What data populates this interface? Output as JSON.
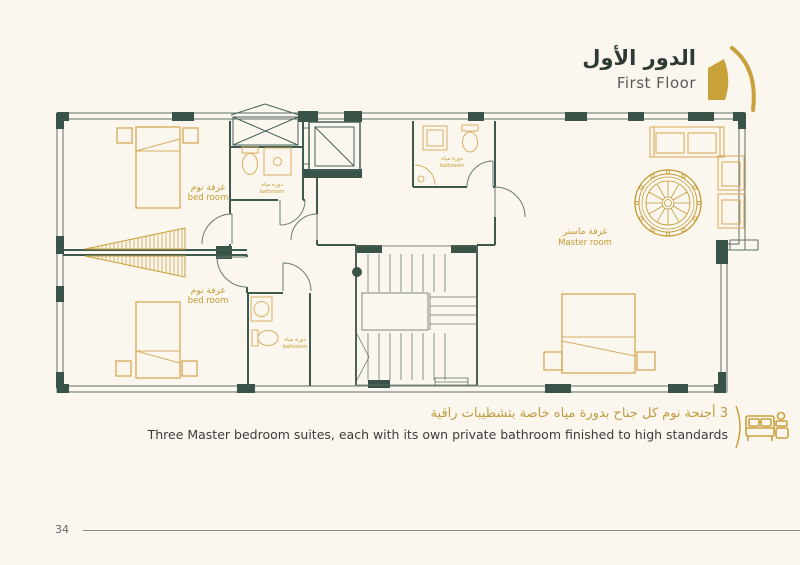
{
  "page": {
    "number": "34"
  },
  "header": {
    "title_ar": "الدور الأول",
    "title_en": "First Floor"
  },
  "plan": {
    "bedroom1": {
      "ar": "غرفة نوم",
      "en": "bed room"
    },
    "bedroom2": {
      "ar": "غرفة نوم",
      "en": "bed room"
    },
    "master": {
      "ar": "غرفة ماستر",
      "en": "Master room"
    },
    "bathroom1": {
      "ar": "دورة مياه",
      "en": "bathroom"
    },
    "bathroom2": {
      "ar": "دورة مياه",
      "en": "bathroom"
    },
    "bathroom3": {
      "ar": "دورة مياه",
      "en": "bathroom"
    }
  },
  "footer": {
    "feature_ar": "3 أجنحة نوم كل جناح بدورة مياه خاصة بتشطيبات راقية",
    "feature_en": "Three Master bedroom suites, each with its own private bathroom finished to high standards"
  },
  "colors": {
    "background": "#FBF7EF",
    "wall_green": "#3A5348",
    "accent_gold": "#C9A13B",
    "furniture_gold": "#D8AE62",
    "text_dark": "#2E3B34"
  }
}
